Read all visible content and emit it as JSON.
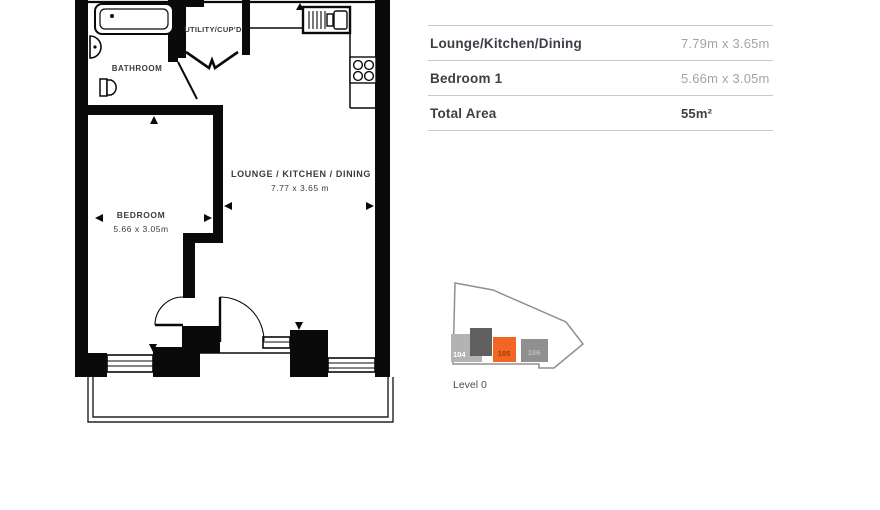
{
  "plan": {
    "labels": {
      "bathroom": "BATHROOM",
      "utility": "UTILITY/CUP'D",
      "lounge": "LOUNGE / KITCHEN / DINING",
      "lounge_dims": "7.77 x 3.65 m",
      "bedroom": "BEDROOM",
      "bedroom_dims": "5.66 x 3.05m"
    },
    "wall_color": "#0a0a0a",
    "text_color": "#3c3c3c"
  },
  "table": {
    "rows": [
      {
        "label": "Lounge/Kitchen/Dining",
        "value": "7.79m x 3.65m"
      },
      {
        "label": "Bedroom 1",
        "value": "5.66m x 3.05m"
      },
      {
        "label": "Total Area",
        "value": "55m²"
      }
    ]
  },
  "level_indicator": {
    "label": "Level 0",
    "units": [
      {
        "id": "104",
        "highlighted": false
      },
      {
        "id": "105",
        "highlighted": true
      },
      {
        "id": "106",
        "highlighted": false
      }
    ],
    "highlight_color": "#f26522",
    "outline_color": "#8f8f8f"
  }
}
